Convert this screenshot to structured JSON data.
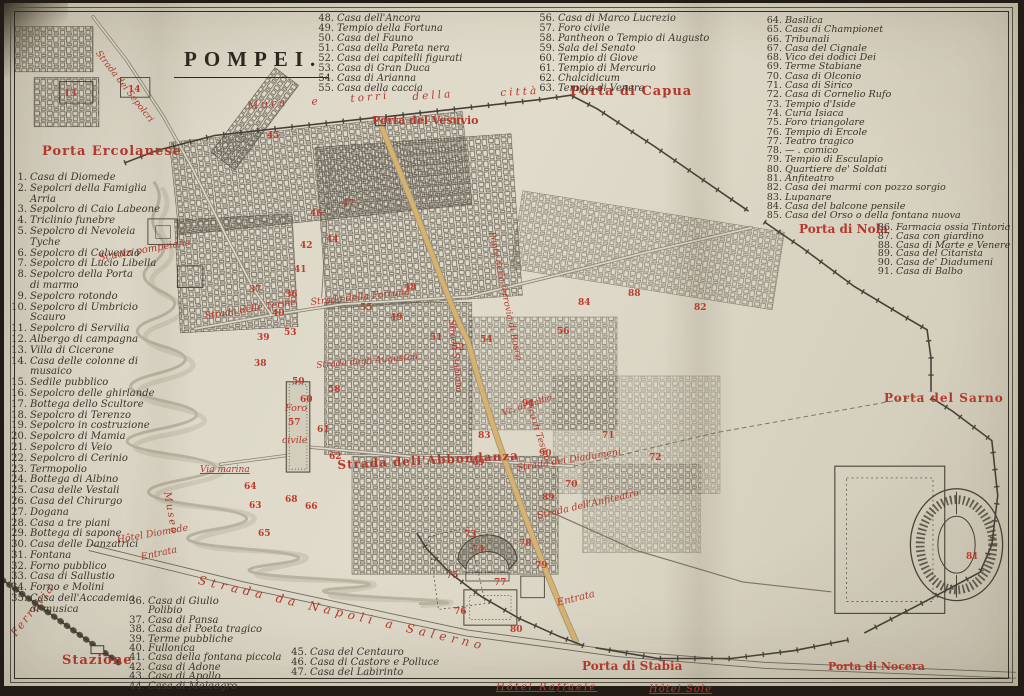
{
  "title": "POMPEI.",
  "colors": {
    "label_red": "#b5382d",
    "number_red": "#c03a2d",
    "ink": "#3a352b",
    "paper": "#ddd8c8",
    "road_ochre": "#d8b26c"
  },
  "legend": {
    "columns": [
      {
        "name": "legend-west",
        "x": 6,
        "y": 170,
        "w": 158,
        "fs": 10,
        "lh": 10.8,
        "items": [
          {
            "n": "1",
            "t": "Casa di Diomede"
          },
          {
            "n": "2",
            "t": "Sepolcri della Famiglia\nArria"
          },
          {
            "n": "3",
            "t": "Sepolcro di Caio Labeone"
          },
          {
            "n": "4",
            "t": "Triclinio funebre"
          },
          {
            "n": "5",
            "t": "Sepolcro di Nevoleia Tyche"
          },
          {
            "n": "6",
            "t": "Sepolcro di Calvenzio"
          },
          {
            "n": "7",
            "t": "Sepolcro di Lucio Libella"
          },
          {
            "n": "8",
            "t": "Sepolcro della Porta\ndi marmo"
          },
          {
            "n": "9",
            "t": "Sepolcro rotondo"
          },
          {
            "n": "10",
            "t": "Sepolcro di Umbricio Scauro"
          },
          {
            "n": "11",
            "t": "Sepolcro di Servilia"
          },
          {
            "n": "12",
            "t": "Albergo di campagna"
          },
          {
            "n": "13",
            "t": "Villa di Cicerone"
          },
          {
            "n": "14",
            "t": "Casa delle colonne di musaico"
          },
          {
            "n": "15",
            "t": "Sedile pubblico"
          },
          {
            "n": "16",
            "t": "Sepolcro delle ghirlande"
          },
          {
            "n": "17",
            "t": "Bottega dello Scultore"
          },
          {
            "n": "18",
            "t": "Sepolcro di Terenzo"
          },
          {
            "n": "19",
            "t": "Sepolcro in costruzione"
          },
          {
            "n": "20",
            "t": "Sepolcro di Mamia"
          },
          {
            "n": "21",
            "t": "Sepolcro di Veio"
          },
          {
            "n": "22",
            "t": "Sepolcro di Cerinio"
          },
          {
            "n": "23",
            "t": "Termopolio"
          },
          {
            "n": "24",
            "t": "Bottega di Albino"
          },
          {
            "n": "25",
            "t": "Casa delle Vestali"
          },
          {
            "n": "26",
            "t": "Casa del Chirurgo"
          },
          {
            "n": "27",
            "t": "Dogana"
          },
          {
            "n": "28",
            "t": "Casa a tre piani"
          },
          {
            "n": "29",
            "t": "Bottega di sapone"
          },
          {
            "n": "30",
            "t": "Casa delle Danzatrici"
          },
          {
            "n": "31",
            "t": "Fontana"
          },
          {
            "n": "32",
            "t": "Forno pubblico"
          },
          {
            "n": "33",
            "t": "Casa di Sallustio"
          },
          {
            "n": "34",
            "t": "Forno e Molini"
          },
          {
            "n": "35",
            "t": "Casa dell'Accademia\ndi musica"
          }
        ]
      },
      {
        "name": "legend-southwest",
        "x": 124,
        "y": 594,
        "w": 180,
        "fs": 10,
        "lh": 9.4,
        "items": [
          {
            "n": "36",
            "t": "Casa di Giulio\nPolibio"
          },
          {
            "n": "37",
            "t": "Casa di Pansa"
          },
          {
            "n": "38",
            "t": "Casa del Poeta tragico"
          },
          {
            "n": "39",
            "t": "Terme pubbliche"
          },
          {
            "n": "40",
            "t": "Fullonica"
          },
          {
            "n": "41",
            "t": "Casa della fontana piccola"
          },
          {
            "n": "42",
            "t": "Casa di Adone"
          },
          {
            "n": "43",
            "t": "Casa di Apollo"
          },
          {
            "n": "44",
            "t": "Casa di Meleagro"
          }
        ]
      },
      {
        "name": "legend-south",
        "x": 286,
        "y": 645,
        "w": 190,
        "fs": 10,
        "lh": 10.2,
        "items": [
          {
            "n": "45",
            "t": "Casa del Centauro"
          },
          {
            "n": "46",
            "t": "Casa di Castore e Polluce"
          },
          {
            "n": "47",
            "t": "Casa del Labirinto"
          }
        ]
      },
      {
        "name": "legend-top-mid",
        "x": 313,
        "y": 11,
        "w": 200,
        "fs": 9.8,
        "lh": 10,
        "items": [
          {
            "n": "48",
            "t": "Casa dell'Ancora"
          },
          {
            "n": "49",
            "t": "Tempio della Fortuna"
          },
          {
            "n": "50",
            "t": "Casa del Fauno"
          },
          {
            "n": "51",
            "t": "Casa della Pareta nera"
          },
          {
            "n": "52",
            "t": "Casa dei capitelli figurati"
          },
          {
            "n": "53",
            "t": "Casa di Gran Duca"
          },
          {
            "n": "54",
            "t": "Casa di Arianna"
          },
          {
            "n": "55",
            "t": "Casa della caccia"
          }
        ]
      },
      {
        "name": "legend-top-mid2",
        "x": 534,
        "y": 11,
        "w": 210,
        "fs": 9.8,
        "lh": 10,
        "items": [
          {
            "n": "56",
            "t": "Casa di Marco Lucrezio"
          },
          {
            "n": "57",
            "t": "Foro civile"
          },
          {
            "n": "58",
            "t": "Pantheon o Tempio di Augusto"
          },
          {
            "n": "59",
            "t": "Sala del Senato"
          },
          {
            "n": "60",
            "t": "Tempio di Giove"
          },
          {
            "n": "61",
            "t": "Tempio di Mercurio"
          },
          {
            "n": "62",
            "t": "Chalcidicum"
          },
          {
            "n": "63",
            "t": "Tempio di Venere"
          }
        ]
      },
      {
        "name": "legend-right",
        "x": 761,
        "y": 13,
        "w": 250,
        "fs": 9.6,
        "lh": 9.3,
        "items": [
          {
            "n": "64",
            "t": "Basilica"
          },
          {
            "n": "65",
            "t": "Casa di Championet"
          },
          {
            "n": "66",
            "t": "Tribunali"
          },
          {
            "n": "67",
            "t": "Casa del Cignale"
          },
          {
            "n": "68",
            "t": "Vico dei dodici Dei"
          },
          {
            "n": "69",
            "t": "Terme Stabiane"
          },
          {
            "n": "70",
            "t": "Casa di Olconio"
          },
          {
            "n": "71",
            "t": "Casa di Sirico"
          },
          {
            "n": "72",
            "t": "Casa di Cornelio Rufo"
          },
          {
            "n": "73",
            "t": "Tempio d'Iside"
          },
          {
            "n": "74",
            "t": "Curia Isiaca"
          },
          {
            "n": "75",
            "t": "Foro triangolare"
          },
          {
            "n": "76",
            "t": "Tempio di Ercole"
          },
          {
            "n": "77",
            "t": "Teatro tragico"
          },
          {
            "n": "78",
            "t": "—  .  comico"
          },
          {
            "n": "79",
            "t": "Tempio di Esculapio"
          },
          {
            "n": "80",
            "t": "Quartiere de' Soldati"
          },
          {
            "n": "81",
            "t": "Anfiteatro"
          },
          {
            "n": "82",
            "t": "Casa dei marmi con pozzo sorgio"
          },
          {
            "n": "83",
            "t": "Lupanare"
          },
          {
            "n": "84",
            "t": "Casa del balcone pensile"
          },
          {
            "n": "85",
            "t": "Casa del Orso o della fontana nuova"
          }
        ]
      },
      {
        "name": "legend-right2",
        "x": 872,
        "y": 221,
        "w": 160,
        "fs": 9.6,
        "lh": 8.8,
        "items": [
          {
            "n": "86",
            "t": "Farmacia ossia Tintoria"
          },
          {
            "n": "87",
            "t": "Casa con giardino"
          },
          {
            "n": "88",
            "t": "Casa di Marte e Venere"
          },
          {
            "n": "89",
            "t": "Casa del Citarista"
          },
          {
            "n": "90",
            "t": "Casa de' Diadumeni"
          },
          {
            "n": "91",
            "t": "Casa di Balbo"
          }
        ]
      }
    ]
  },
  "map": {
    "labels": [
      {
        "name": "gate-ercolanese",
        "t": "Porta Ercolanese",
        "x": 38,
        "y": 141,
        "fs": 13,
        "b": 1,
        "ls": 1
      },
      {
        "name": "gate-vesuvio",
        "t": "Porta del Vesuvio",
        "x": 368,
        "y": 111,
        "fs": 11,
        "b": 1
      },
      {
        "name": "gate-capua",
        "t": "Porta di Capua",
        "x": 566,
        "y": 81,
        "fs": 13,
        "b": 1,
        "ls": 1
      },
      {
        "name": "gate-nola",
        "t": "Porta di Nola",
        "x": 795,
        "y": 219,
        "fs": 12,
        "b": 1
      },
      {
        "name": "gate-sarno",
        "t": "Porta del Sarno",
        "x": 880,
        "y": 388,
        "fs": 12,
        "b": 1,
        "ls": 1
      },
      {
        "name": "gate-stabia",
        "t": "Porta di Stabia",
        "x": 578,
        "y": 656,
        "fs": 12,
        "b": 1
      },
      {
        "name": "gate-nocera",
        "t": "Porta di Nocera",
        "x": 824,
        "y": 657,
        "fs": 11,
        "b": 1
      },
      {
        "name": "station-label",
        "t": "Stazione",
        "x": 58,
        "y": 650,
        "fs": 13,
        "b": 1,
        "ls": 1
      },
      {
        "name": "railway-label",
        "t": "Ferrovia",
        "x": 4,
        "y": 628,
        "fs": 11,
        "rot": -52,
        "ls": 2
      },
      {
        "name": "road-napoli-salerno",
        "t": "Strada da Napoli a Salerno",
        "x": 196,
        "y": 570,
        "fs": 12,
        "rot": 13,
        "ls": 5
      },
      {
        "name": "hotel-diomede",
        "t": "Hôtel Diomede",
        "x": 112,
        "y": 532,
        "fs": 9.5,
        "rot": -10
      },
      {
        "name": "entrance-west",
        "t": "Entrata",
        "x": 136,
        "y": 549,
        "fs": 9.5,
        "rot": -12
      },
      {
        "name": "entrance-east",
        "t": "Entrata",
        "x": 552,
        "y": 595,
        "fs": 10,
        "rot": -14
      },
      {
        "name": "hotel-raffaele",
        "t": "Hôtel Raffaele",
        "x": 492,
        "y": 679,
        "fs": 10,
        "u": 1,
        "ls": 2
      },
      {
        "name": "hotel-sole",
        "t": "Hôtel Sole",
        "x": 645,
        "y": 681,
        "fs": 10,
        "u": 1,
        "ls": 1
      },
      {
        "name": "wall-label-1",
        "t": "Mura",
        "x": 243,
        "y": 97,
        "fs": 10.5,
        "rot": -5,
        "ls": 3
      },
      {
        "name": "wall-label-2",
        "t": "e",
        "x": 307,
        "y": 93,
        "fs": 10.5,
        "rot": -5
      },
      {
        "name": "wall-label-3",
        "t": "torri",
        "x": 346,
        "y": 90,
        "fs": 10.5,
        "rot": -5,
        "ls": 3
      },
      {
        "name": "wall-label-4",
        "t": "della",
        "x": 408,
        "y": 88,
        "fs": 10.5,
        "rot": -4,
        "ls": 3
      },
      {
        "name": "wall-label-5",
        "t": "città",
        "x": 496,
        "y": 84,
        "fs": 10.5,
        "rot": -3,
        "ls": 3
      },
      {
        "name": "school-label",
        "t": "Scuola pompeiana",
        "x": 94,
        "y": 250,
        "fs": 10,
        "rot": -10
      },
      {
        "name": "street-terme",
        "t": "Strada delle Terme",
        "x": 200,
        "y": 308,
        "fs": 9.5,
        "rot": -9
      },
      {
        "name": "street-fortuna",
        "t": "Strada della Fortuna",
        "x": 306,
        "y": 294,
        "fs": 9.5,
        "rot": -6
      },
      {
        "name": "street-augustali",
        "t": "Strada degli Augustali",
        "x": 312,
        "y": 358,
        "fs": 9,
        "rot": -5
      },
      {
        "name": "street-abbondanza",
        "t": "Strada dell'Abbondanza",
        "x": 333,
        "y": 455,
        "fs": 12,
        "b": 1,
        "rot": -3,
        "ls": 1
      },
      {
        "name": "street-diadumeni",
        "t": "Strada dei Diadumeni",
        "x": 512,
        "y": 460,
        "fs": 9.5,
        "rot": -9
      },
      {
        "name": "street-anfiteatro",
        "t": "Strada dell'Anfiteatro",
        "x": 532,
        "y": 508,
        "fs": 9.5,
        "rot": -13
      },
      {
        "name": "street-vico-tesmo",
        "t": "Vico di Tesmo",
        "x": 528,
        "y": 396,
        "fs": 9,
        "rot": 72
      },
      {
        "name": "street-vico-balbo",
        "t": "Vc. di Balbo",
        "x": 497,
        "y": 406,
        "fs": 8.5,
        "rot": -18
      },
      {
        "name": "street-marina",
        "t": "Via marina",
        "x": 196,
        "y": 462,
        "fs": 9,
        "u": 1
      },
      {
        "name": "museum-label",
        "t": "Museo",
        "x": 168,
        "y": 488,
        "fs": 10,
        "rot": 80,
        "ls": 2
      },
      {
        "name": "street-sepolcri",
        "t": "Strada dei Sepolcri",
        "x": 97,
        "y": 46,
        "fs": 9,
        "rot": 52
      },
      {
        "name": "street-stabiana",
        "t": "Strada Stabiana",
        "x": 452,
        "y": 316,
        "fs": 9,
        "rot": 84
      },
      {
        "name": "bridge-bosco",
        "t": "Ponte della ferrovia di Bosco",
        "x": 492,
        "y": 228,
        "fs": 9,
        "rot": 78
      },
      {
        "name": "forum-label-1",
        "t": "Foro",
        "x": 281,
        "y": 400,
        "fs": 9.5
      },
      {
        "name": "forum-label-2",
        "t": "civile",
        "x": 278,
        "y": 432,
        "fs": 9.5
      }
    ],
    "numbers": [
      {
        "n": "13",
        "x": 60,
        "y": 86
      },
      {
        "n": "14",
        "x": 124,
        "y": 82
      },
      {
        "n": "45",
        "x": 263,
        "y": 128
      },
      {
        "n": "46",
        "x": 306,
        "y": 206
      },
      {
        "n": "47",
        "x": 338,
        "y": 196
      },
      {
        "n": "44",
        "x": 322,
        "y": 232
      },
      {
        "n": "42",
        "x": 296,
        "y": 238
      },
      {
        "n": "41",
        "x": 290,
        "y": 262
      },
      {
        "n": "40",
        "x": 268,
        "y": 306
      },
      {
        "n": "39",
        "x": 253,
        "y": 330
      },
      {
        "n": "38",
        "x": 250,
        "y": 356
      },
      {
        "n": "37",
        "x": 245,
        "y": 282
      },
      {
        "n": "36",
        "x": 281,
        "y": 287
      },
      {
        "n": "50",
        "x": 288,
        "y": 374
      },
      {
        "n": "53",
        "x": 280,
        "y": 325
      },
      {
        "n": "55",
        "x": 356,
        "y": 300
      },
      {
        "n": "49",
        "x": 386,
        "y": 310
      },
      {
        "n": "48",
        "x": 400,
        "y": 280
      },
      {
        "n": "51",
        "x": 426,
        "y": 330
      },
      {
        "n": "52",
        "x": 448,
        "y": 340
      },
      {
        "n": "54",
        "x": 476,
        "y": 332
      },
      {
        "n": "58",
        "x": 324,
        "y": 382
      },
      {
        "n": "60",
        "x": 296,
        "y": 392
      },
      {
        "n": "61",
        "x": 313,
        "y": 422
      },
      {
        "n": "62",
        "x": 325,
        "y": 449
      },
      {
        "n": "63",
        "x": 245,
        "y": 498
      },
      {
        "n": "64",
        "x": 240,
        "y": 479
      },
      {
        "n": "65",
        "x": 254,
        "y": 526
      },
      {
        "n": "66",
        "x": 301,
        "y": 499
      },
      {
        "n": "68",
        "x": 281,
        "y": 492
      },
      {
        "n": "57",
        "x": 284,
        "y": 415
      },
      {
        "n": "69",
        "x": 468,
        "y": 455
      },
      {
        "n": "70",
        "x": 561,
        "y": 477
      },
      {
        "n": "71",
        "x": 598,
        "y": 428
      },
      {
        "n": "72",
        "x": 645,
        "y": 450
      },
      {
        "n": "73",
        "x": 460,
        "y": 527
      },
      {
        "n": "74",
        "x": 468,
        "y": 542
      },
      {
        "n": "75",
        "x": 442,
        "y": 568
      },
      {
        "n": "76",
        "x": 450,
        "y": 604
      },
      {
        "n": "77",
        "x": 490,
        "y": 575
      },
      {
        "n": "78",
        "x": 515,
        "y": 536
      },
      {
        "n": "79",
        "x": 531,
        "y": 558
      },
      {
        "n": "80",
        "x": 506,
        "y": 622
      },
      {
        "n": "81",
        "x": 962,
        "y": 549
      },
      {
        "n": "82",
        "x": 690,
        "y": 300
      },
      {
        "n": "83",
        "x": 474,
        "y": 428
      },
      {
        "n": "84",
        "x": 574,
        "y": 295
      },
      {
        "n": "88",
        "x": 624,
        "y": 286
      },
      {
        "n": "56",
        "x": 553,
        "y": 324
      },
      {
        "n": "89",
        "x": 538,
        "y": 490
      },
      {
        "n": "90",
        "x": 535,
        "y": 446
      },
      {
        "n": "91",
        "x": 518,
        "y": 396
      }
    ]
  }
}
